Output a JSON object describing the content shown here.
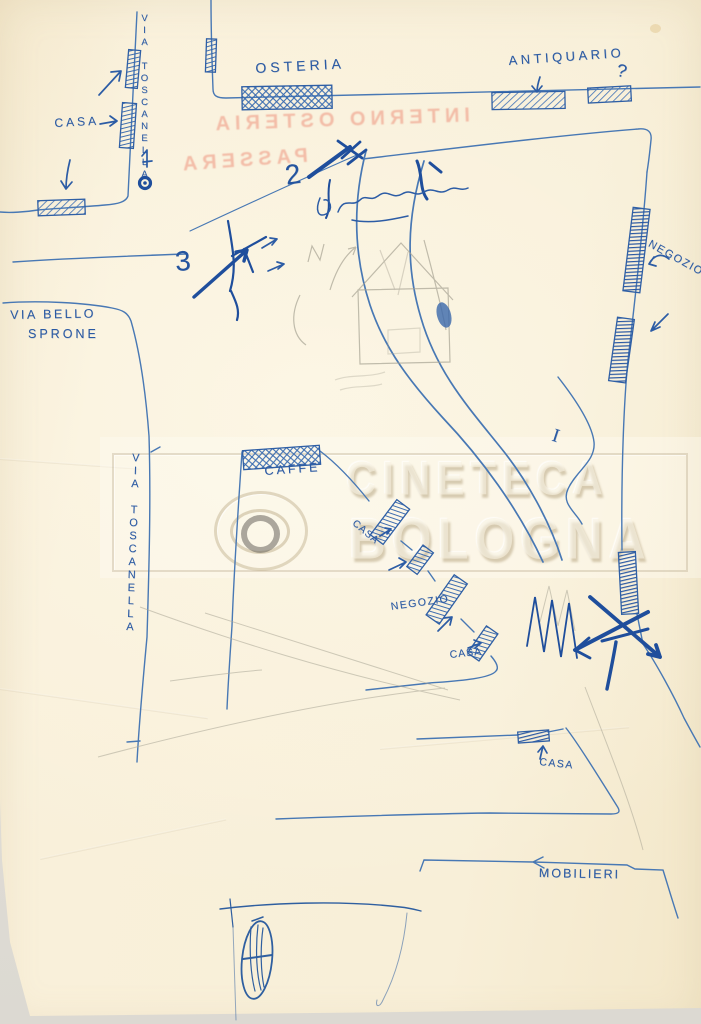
{
  "page": {
    "colors": {
      "paper": "#f8efd9",
      "ink": "#2e5ea6",
      "ink_dark": "#1f4e9c",
      "pencil": "#a8a494",
      "bleedthrough": "#ee9a83",
      "watermark": "#f7f0de"
    }
  },
  "watermark": {
    "line1": "CINETECA",
    "line2": "BOLOGNA"
  },
  "bleedthrough": {
    "line1": "INTERNO OSTERIA",
    "line2": "PASSERA"
  },
  "labels": {
    "via_toscanella_top": "VIA TOSCANELLA",
    "casa_top": "CASA",
    "osteria": "OSTERIA",
    "antiquario": "ANTIQUARIO",
    "question_mark": "?",
    "negozio_right": "NEGOZIO",
    "number_2": "2",
    "number_3": "3",
    "roman_numeral_i": "I",
    "via_bello_line1": "VIA BELLO",
    "via_bello_line2": "SPRONE",
    "via_toscanella_mid": "VIA TOSCANELLA",
    "caffe": "CAFFÉ",
    "casa_chain_upper": "CASA",
    "negozio_mid": "NEGOZIO",
    "casa_chain_lower": "CASA",
    "casa_bottom": "CASA",
    "mobilieri": "MOBILIERI"
  }
}
